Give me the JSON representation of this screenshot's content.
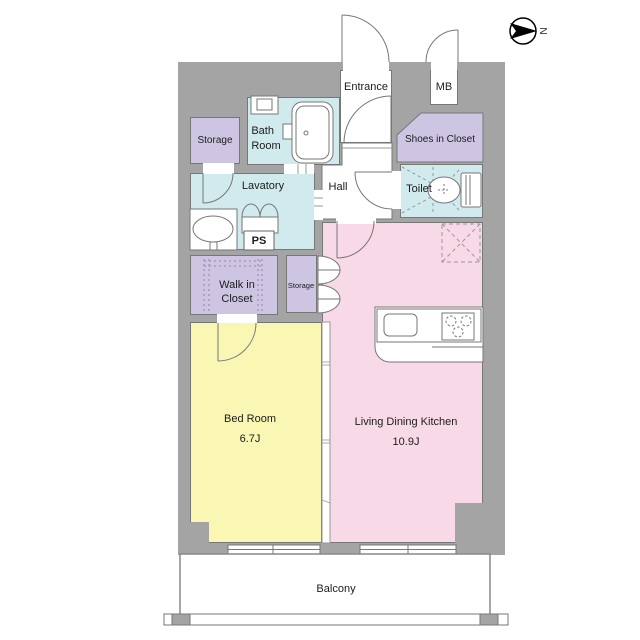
{
  "figure": "apartment floor plan",
  "compass": {
    "label": "N"
  },
  "colors": {
    "wall": "#a4a4a4",
    "outline": "#777777",
    "pink": "#f8d9e7",
    "yellow": "#faf7b4",
    "lavender": "#cec5e3",
    "cyan": "#d0eaee",
    "white": "#ffffff"
  },
  "rooms": {
    "storage_top": {
      "label": "Storage"
    },
    "bath": {
      "line1": "Bath",
      "line2": "Room"
    },
    "entrance": {
      "label": "Entrance"
    },
    "mb": {
      "label": "MB"
    },
    "shoes": {
      "label": "Shoes in Closet"
    },
    "lavatory": {
      "label": "Lavatory"
    },
    "hall": {
      "label": "Hall"
    },
    "toilet": {
      "label": "Toilet"
    },
    "ps": {
      "label": "PS"
    },
    "wic": {
      "line1": "Walk in",
      "line2": "Closet"
    },
    "storage_small": {
      "label": "Storage"
    },
    "bedroom": {
      "label": "Bed Room",
      "size": "6.7J"
    },
    "ldk": {
      "label": "Living Dining Kitchen",
      "size": "10.9J"
    },
    "balcony": {
      "label": "Balcony"
    }
  }
}
